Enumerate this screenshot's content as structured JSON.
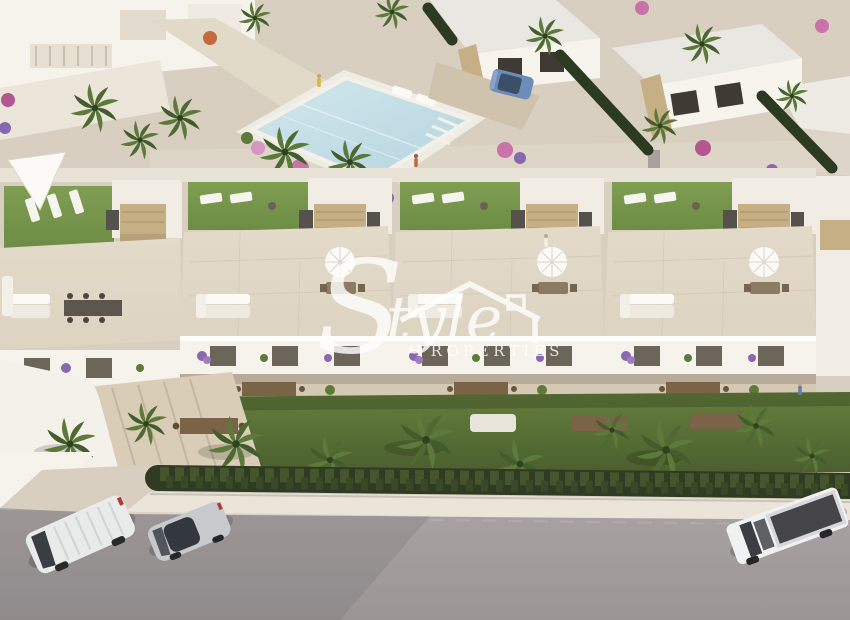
{
  "watermark": {
    "brand_initial": "S",
    "brand_script_rest": "tyle",
    "brand_caption": "PROPERTIES"
  },
  "palette": {
    "road": "#a8a2a3",
    "road_dark": "#9b9596",
    "sidewalk": "#eae4d9",
    "hedge": "#2f3b22",
    "hedge_light": "#45552c",
    "lawn_sun": "#7f9e52",
    "lawn_shade": "#495d2d",
    "tile": "#ddd3c1",
    "walkway": "#e7e0d2",
    "building_white": "#f8f5ef",
    "building_shade": "#dcd5c8",
    "stone_clad": "#c6ae85",
    "pool_water": "#b5d5e0",
    "palm_green": "#5c7a39",
    "palm_dark": "#425c2c",
    "flower_pink": "#c873aa",
    "flower_purple": "#8a68b0",
    "vehicle_white": "#e9eaea",
    "vehicle_silver": "#c7c9cc",
    "truck_bed": "#454548",
    "parked_car_blue": "#6d8cba",
    "watermark_white": "#ffffff"
  }
}
